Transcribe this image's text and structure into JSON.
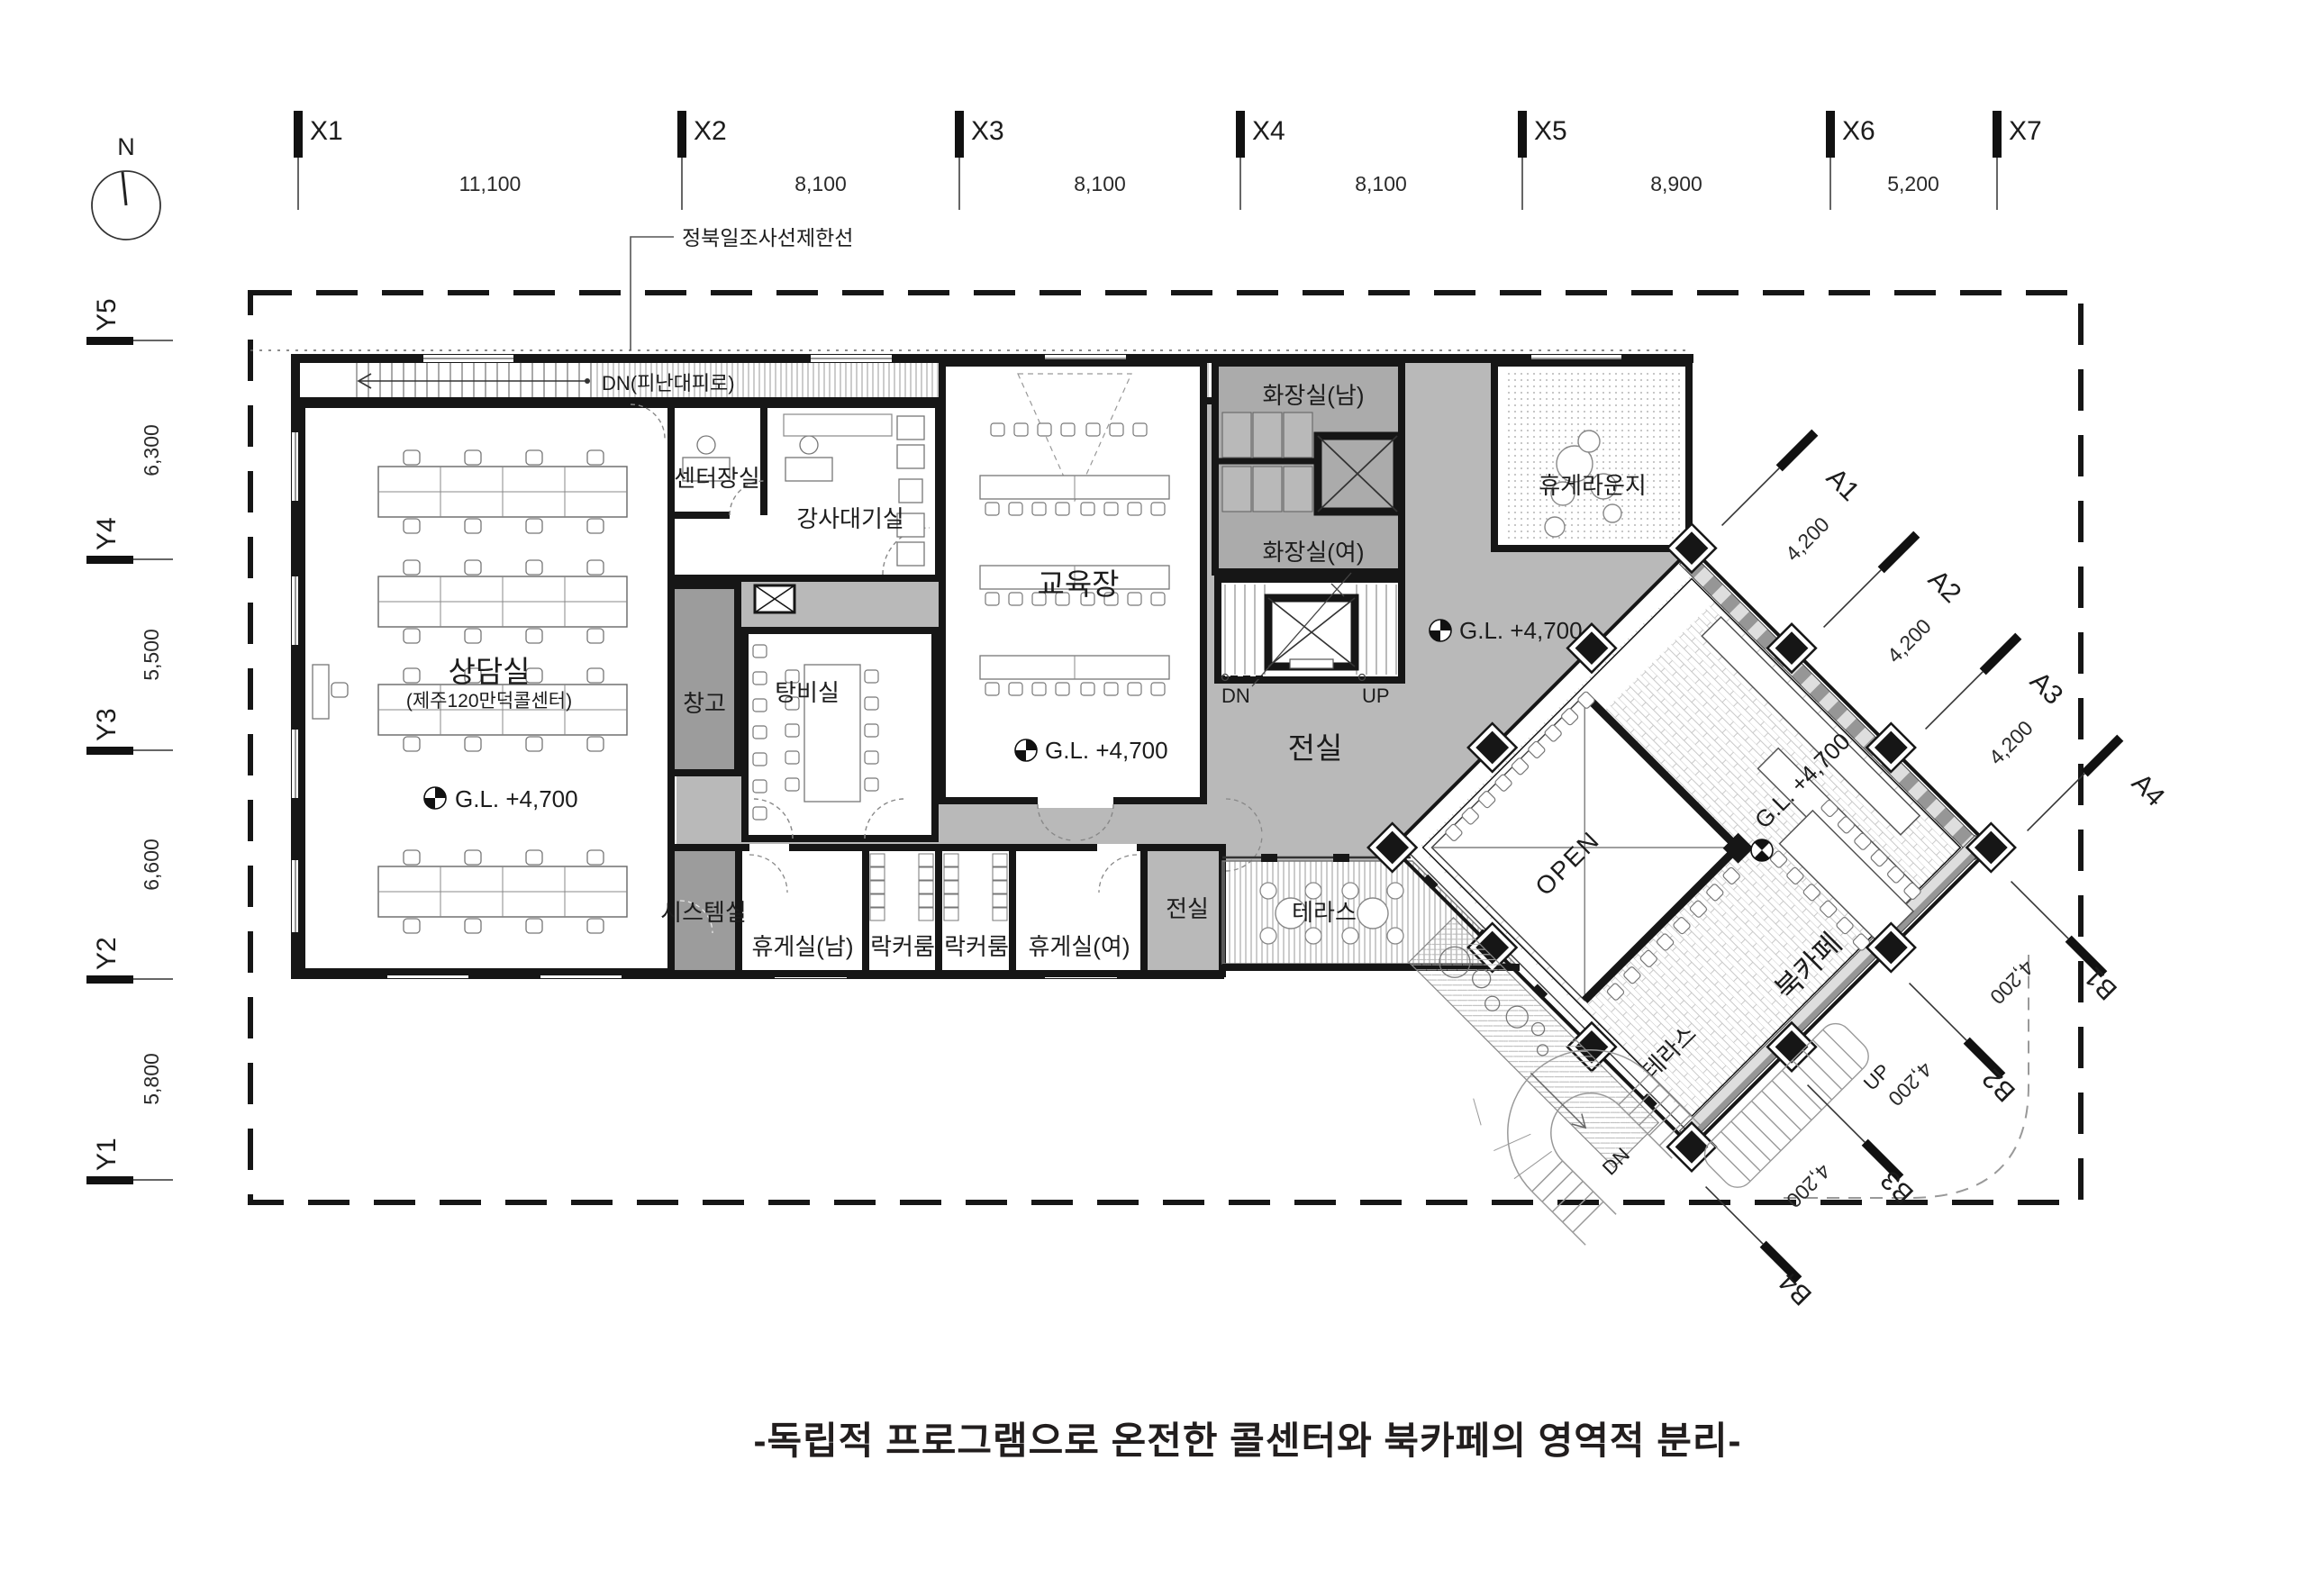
{
  "north": "N",
  "site_note": "정북일조사선제한선",
  "caption": "-독립적 프로그램으로 온전한 콜센터와 북카페의 영역적 분리-",
  "grid": {
    "x_labels": [
      "X1",
      "X2",
      "X3",
      "X4",
      "X5",
      "X6",
      "X7"
    ],
    "x_dims": [
      "11,100",
      "8,100",
      "8,100",
      "8,100",
      "8,900",
      "5,200"
    ],
    "y_labels": [
      "Y5",
      "Y4",
      "Y3",
      "Y2",
      "Y1"
    ],
    "y_dims": [
      "6,300",
      "5,500",
      "6,600",
      "5,800"
    ],
    "a_labels": [
      "A1",
      "A2",
      "A3",
      "A4"
    ],
    "a_dims": [
      "4,200",
      "4,200",
      "4,200"
    ],
    "b_labels": [
      "B1",
      "B2",
      "B3",
      "B4"
    ],
    "b_dims": [
      "4,200",
      "4,200",
      "4,200"
    ]
  },
  "rooms": {
    "sangdamsil": "상담실",
    "sangdamsil_sub": "(제주120만덕콜센터)",
    "center_office": "센터장실",
    "instructor_wait": "강사대기실",
    "education": "교육장",
    "pantry": "탕비실",
    "storage": "창고",
    "toilet_m": "화장실(남)",
    "toilet_f": "화장실(여)",
    "lounge": "휴게라운지",
    "system": "시스템실",
    "rest_m": "휴게실(남)",
    "locker_a": "락커룸",
    "locker_b": "락커룸",
    "rest_f": "휴게실(여)",
    "vestibule_small": "전실",
    "vestibule_hall": "전실",
    "terrace_west": "테라스",
    "terrace_south": "테라스",
    "book_cafe": "북카페",
    "open_void": "OPEN"
  },
  "levels": {
    "gl": "G.L. +4,700"
  },
  "circulation": {
    "dn_escape": "DN(피난대피로)",
    "dn": "DN",
    "up": "UP"
  }
}
